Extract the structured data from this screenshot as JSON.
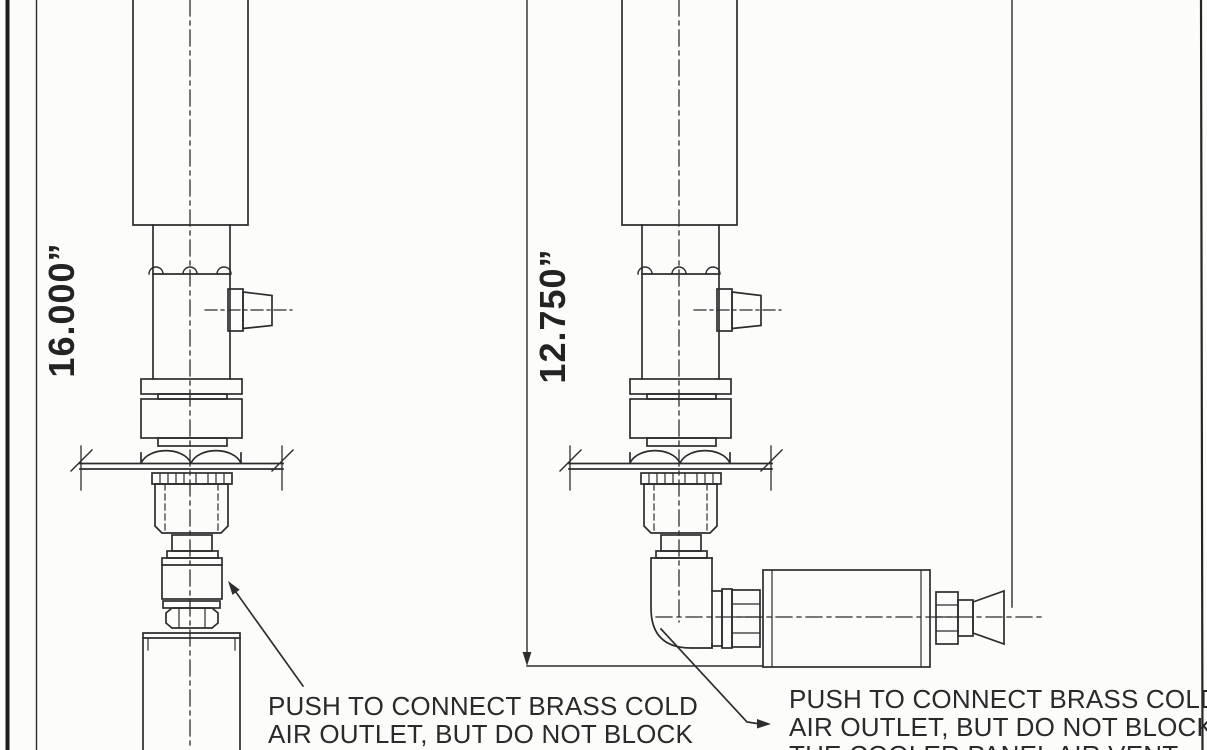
{
  "page": {
    "background_color": "#fcfcfb",
    "ink_color": "#2d2d2d",
    "description": "Technical line drawing of two panel-mounted cooler cold-air outlet assemblies"
  },
  "views": {
    "left": {
      "dimension_label": "16.000”",
      "callout": {
        "line1": "PUSH TO CONNECT BRASS COLD",
        "line2": "AIR OUTLET, BUT DO NOT BLOCK",
        "line3": "THE COOLER PANEL AIR VENT"
      }
    },
    "right": {
      "dimension_label": "12.750”",
      "callout": {
        "line1": "PUSH TO CONNECT BRASS COLD",
        "line2": "AIR OUTLET, BUT DO NOT BLOCK",
        "line3": "THE COOLER PANEL AIR VENT"
      }
    }
  }
}
